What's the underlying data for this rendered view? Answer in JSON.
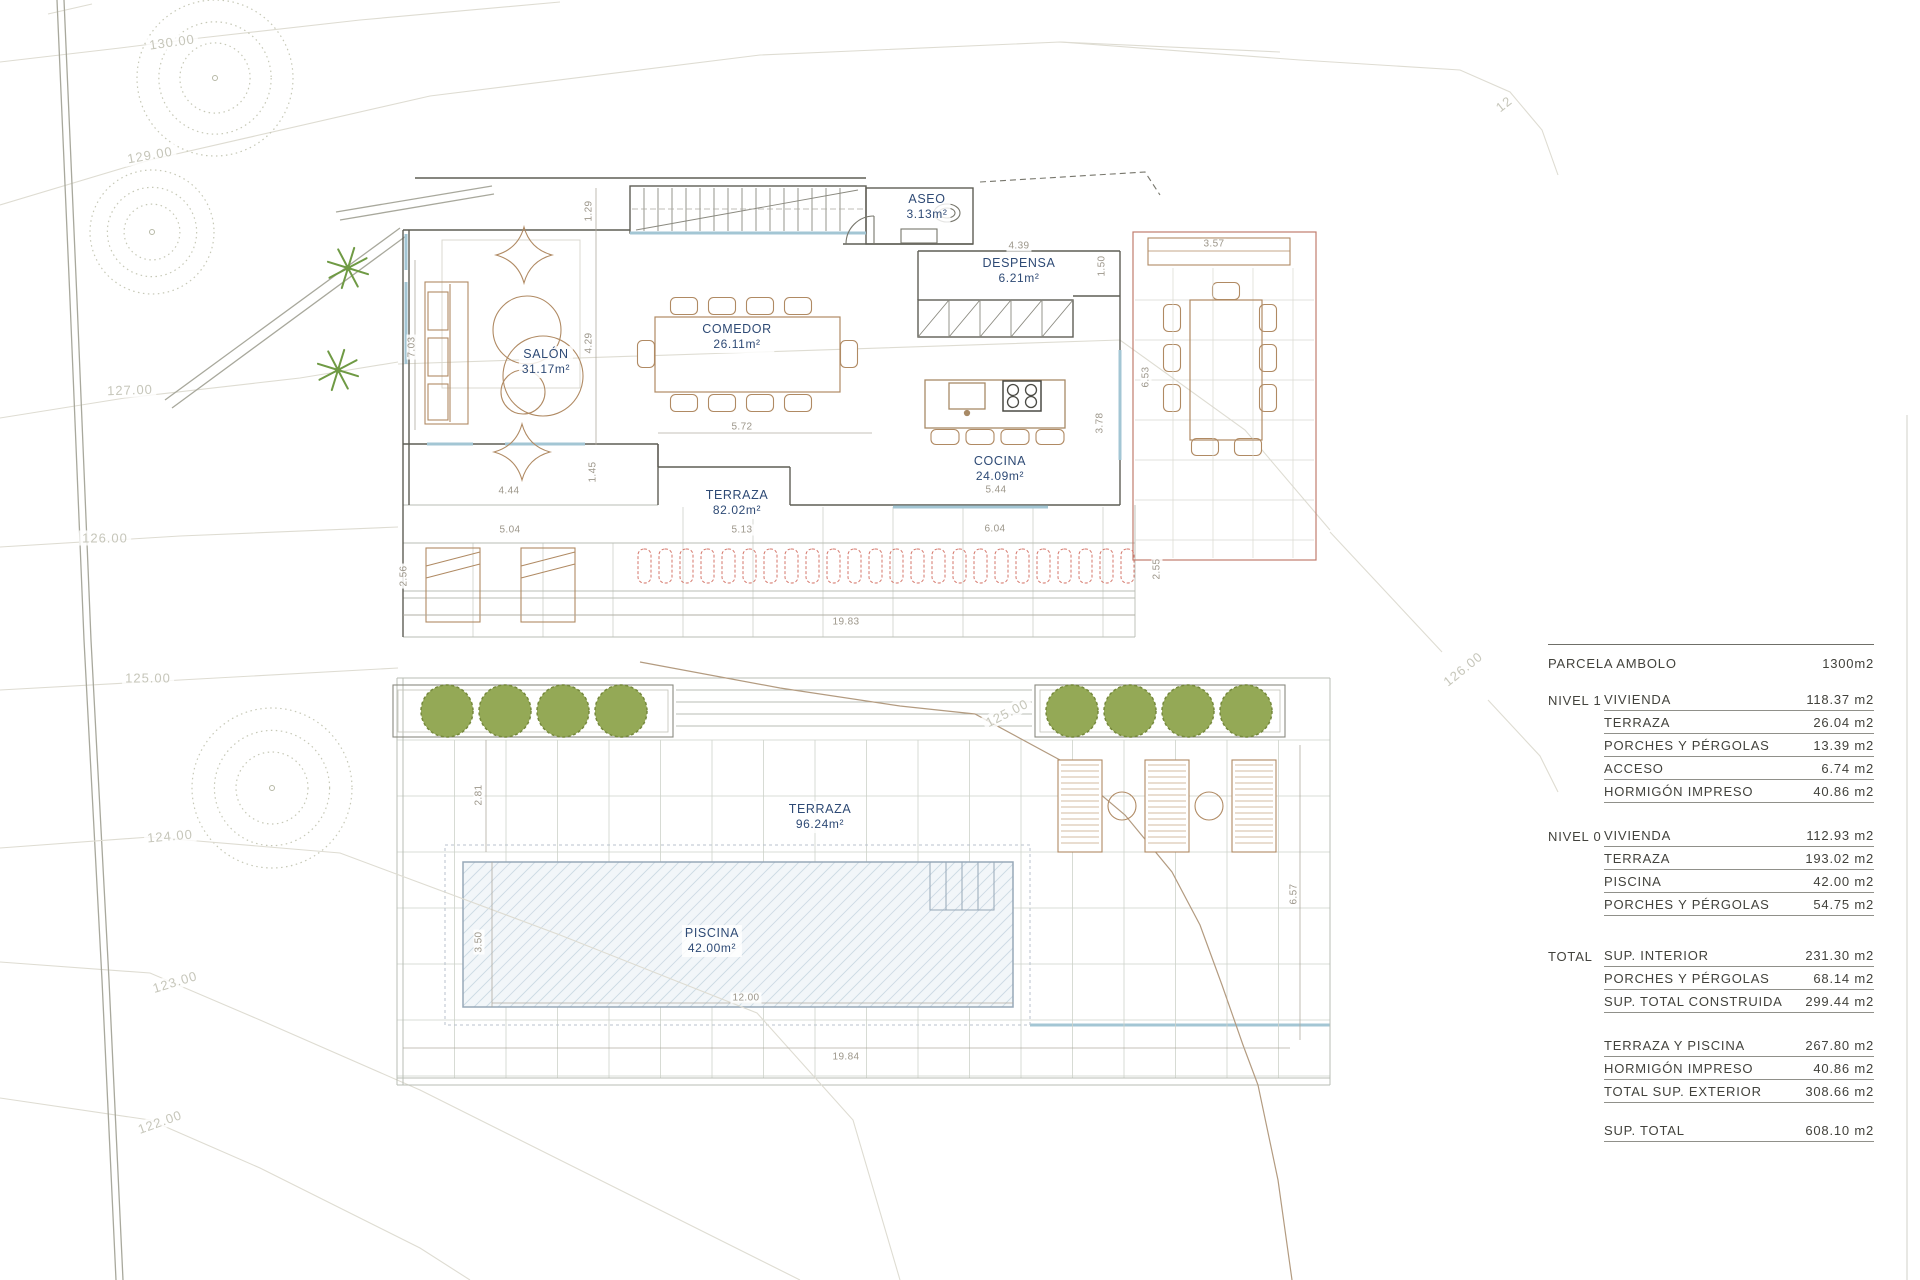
{
  "contour_labels": {
    "c130": "130.00",
    "c129": "129.00",
    "c127": "127.00",
    "c126_left": "126.00",
    "c125_left": "125.00",
    "c124": "124.00",
    "c123": "123.00",
    "c122": "122.00",
    "c125_mid": "125.00",
    "c126_right": "126.00",
    "c12_top": "12"
  },
  "upper_plan": {
    "rooms": {
      "salon": {
        "name": "SALÓN",
        "area": "31.17m²"
      },
      "comedor": {
        "name": "COMEDOR",
        "area": "26.11m²"
      },
      "aseo": {
        "name": "ASEO",
        "area": "3.13m²"
      },
      "despensa": {
        "name": "DESPENSA",
        "area": "6.21m²"
      },
      "cocina": {
        "name": "COCINA",
        "area": "24.09m²"
      },
      "terraza": {
        "name": "TERRAZA",
        "area": "82.02m²"
      }
    },
    "dims": {
      "d129": "1.29",
      "d703": "7.03",
      "d429": "4.29",
      "d444": "4.44",
      "d145": "1.45",
      "d572": "5.72",
      "d504": "5.04",
      "d513": "5.13",
      "d604": "6.04",
      "d544": "5.44",
      "d378": "3.78",
      "d653": "6.53",
      "d357": "3.57",
      "d439": "4.39",
      "d150": "1.50",
      "d256": "2.56",
      "d255": "2.55",
      "d1983": "19.83"
    }
  },
  "lower_plan": {
    "rooms": {
      "terraza": {
        "name": "TERRAZA",
        "area": "96.24m²"
      },
      "piscina": {
        "name": "PISCINA",
        "area": "42.00m²"
      }
    },
    "dims": {
      "d281": "2.81",
      "d350": "3.50",
      "d1200": "12.00",
      "d1984": "19.84",
      "d657": "6.57"
    }
  },
  "summary_table": {
    "parcel_label": "PARCELA AMBOLO",
    "parcel_value": "1300m2",
    "nivel1_label": "NIVEL 1",
    "nivel1": [
      {
        "name": "VIVIENDA",
        "value": "118.37 m2"
      },
      {
        "name": "TERRAZA",
        "value": "26.04 m2"
      },
      {
        "name": "PORCHES Y PÉRGOLAS",
        "value": "13.39 m2"
      },
      {
        "name": "ACCESO",
        "value": "6.74 m2"
      },
      {
        "name": "HORMIGÓN IMPRESO",
        "value": "40.86 m2"
      }
    ],
    "nivel0_label": "NIVEL 0",
    "nivel0": [
      {
        "name": "VIVIENDA",
        "value": "112.93 m2"
      },
      {
        "name": "TERRAZA",
        "value": "193.02 m2"
      },
      {
        "name": "PISCINA",
        "value": "42.00 m2"
      },
      {
        "name": "PORCHES Y PÉRGOLAS",
        "value": "54.75 m2"
      }
    ],
    "total_label": "TOTAL",
    "total": [
      {
        "name": "SUP. INTERIOR",
        "value": "231.30 m2"
      },
      {
        "name": "PORCHES Y PÉRGOLAS",
        "value": "68.14 m2"
      },
      {
        "name": "SUP. TOTAL CONSTRUIDA",
        "value": "299.44 m2"
      }
    ],
    "exterior": [
      {
        "name": "TERRAZA Y PISCINA",
        "value": "267.80 m2"
      },
      {
        "name": "HORMIGÓN IMPRESO",
        "value": "40.86 m2"
      },
      {
        "name": "TOTAL SUP. EXTERIOR",
        "value": "308.66 m2"
      }
    ],
    "grand": [
      {
        "name": "SUP. TOTAL",
        "value": "608.10 m2"
      }
    ]
  },
  "colors": {
    "room_label_navy": "#2e4a75",
    "dimension_gray": "#9c968a",
    "pergola_red": "#d4766a",
    "glazing_blue": "#a3c6d4",
    "vegetation_green": "#94a956",
    "furniture_tan": "#b08a63",
    "contour_gray": "#c6c6ba"
  }
}
